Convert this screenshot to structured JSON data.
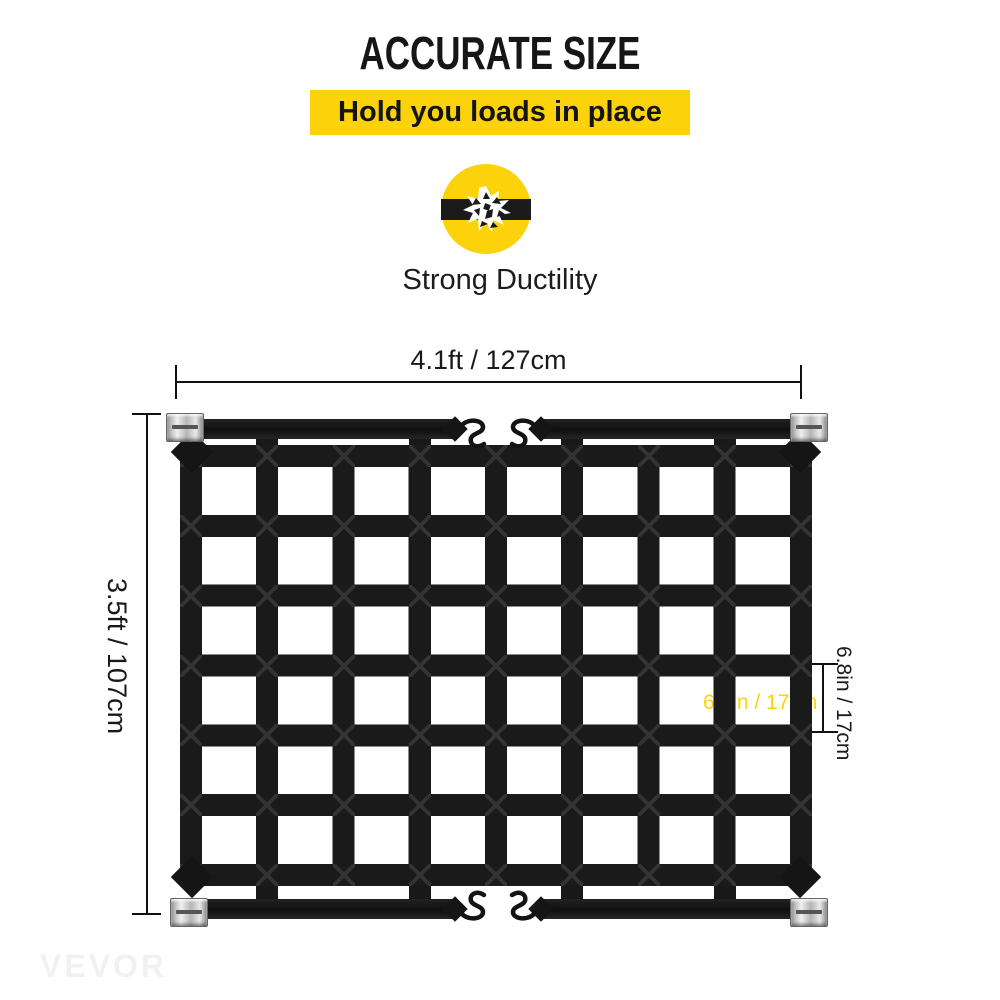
{
  "header": {
    "title": "ACCURATE SIZE",
    "subtitle": "Hold you loads in place"
  },
  "feature": {
    "label": "Strong Ductility",
    "icon": "broken-strap-burst-icon"
  },
  "dimensions": {
    "width_label": "4.1ft / 127cm",
    "height_label": "3.5ft / 107cm",
    "cell_width_label": "6.8in / 17cm",
    "cell_height_label": "6.8in / 17cm"
  },
  "net": {
    "columns": 8,
    "rows": 6,
    "hardware": [
      "cam-buckle",
      "s-hook"
    ]
  },
  "brand": {
    "watermark": "VEVOR"
  },
  "colors": {
    "yellow": "#FCD30A",
    "ink": "#111111",
    "strap_black": "#1A1A1A",
    "metal_silver": "#C9C9C9"
  }
}
